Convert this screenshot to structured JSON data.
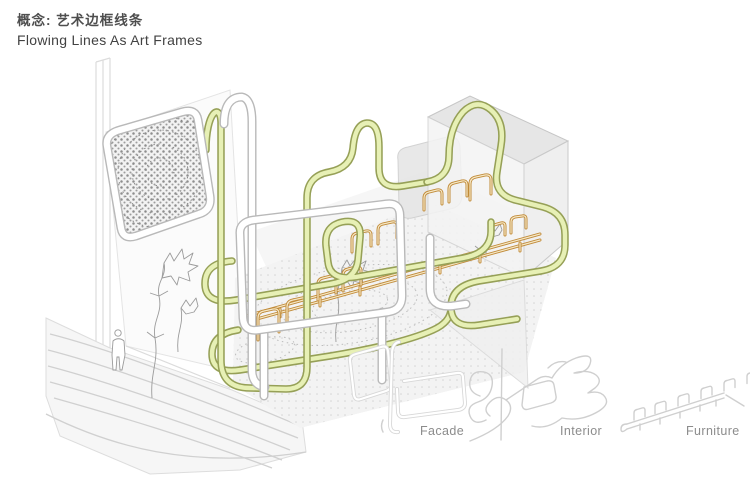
{
  "title": {
    "zh": "概念: 艺术边框线条",
    "en": "Flowing Lines As Art Frames"
  },
  "legend": {
    "items": [
      {
        "id": "facade",
        "label": "Facade"
      },
      {
        "id": "interior",
        "label": "Interior"
      },
      {
        "id": "furniture",
        "label": "Furniture"
      }
    ]
  },
  "colors": {
    "flow_line_green_fill": "#e7f0b5",
    "flow_line_green_edge": "#96a057",
    "furniture_line_orange": "#c08a38",
    "facade_tube_white_edge": "#b9b9b9",
    "volume_gray": "#ededed",
    "halftone_dot_gray": "#8e8e8e",
    "legend_line_gray": "#cfcfcf",
    "label_text_gray": "#8c8c8c",
    "title_text": "#4a4a4a",
    "background": "#ffffff"
  }
}
